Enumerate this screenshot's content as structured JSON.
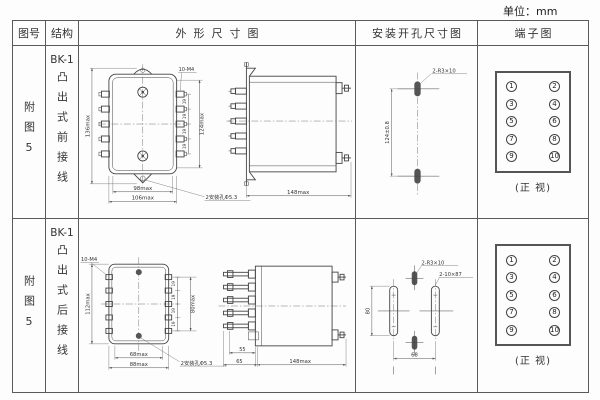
{
  "unit_label": "单位：mm",
  "headers": {
    "figure": "图号",
    "structure": "结构",
    "outline": "外形尺寸图",
    "install": "安装开孔尺寸图",
    "terminal": "端子图"
  },
  "rows": [
    {
      "figure_no": "附图5",
      "model": "BK-1",
      "structure": "凸出式前接线",
      "outline": {
        "height_overall": "136max",
        "terminal_span": "124max",
        "pitch": "19",
        "screw_label": "10-M4",
        "width_inner": "98max",
        "width_overall": "106max",
        "mount_hole_label": "2安装孔Φ5.3",
        "depth": "148max"
      },
      "install": {
        "pitch_v": "124±0.8",
        "slot_label": "2-R3×10"
      },
      "terminal": {
        "caption": "(正 视)",
        "numbers": [
          "1",
          "2",
          "3",
          "4",
          "5",
          "6",
          "7",
          "8",
          "9",
          "10"
        ]
      }
    },
    {
      "figure_no": "附图5",
      "model": "BK-1",
      "structure": "凸出式后接线",
      "outline": {
        "screw_label": "10-M4",
        "height_overall": "112max",
        "terminal_span": "80max",
        "pitch": "19",
        "width_inner": "68max",
        "width_overall": "88max",
        "mount_hole_label": "2安装孔Φ5.3",
        "stud_inner": "55",
        "stud_outer": "65",
        "depth": "148max"
      },
      "install": {
        "slot_small_label": "2-R3×10",
        "slot_long_label": "2-10×87",
        "pitch_v": "80",
        "pitch_h": "68"
      },
      "terminal": {
        "caption": "(正 视)",
        "numbers": [
          "1",
          "2",
          "3",
          "4",
          "5",
          "6",
          "7",
          "8",
          "9",
          "10"
        ]
      }
    }
  ]
}
